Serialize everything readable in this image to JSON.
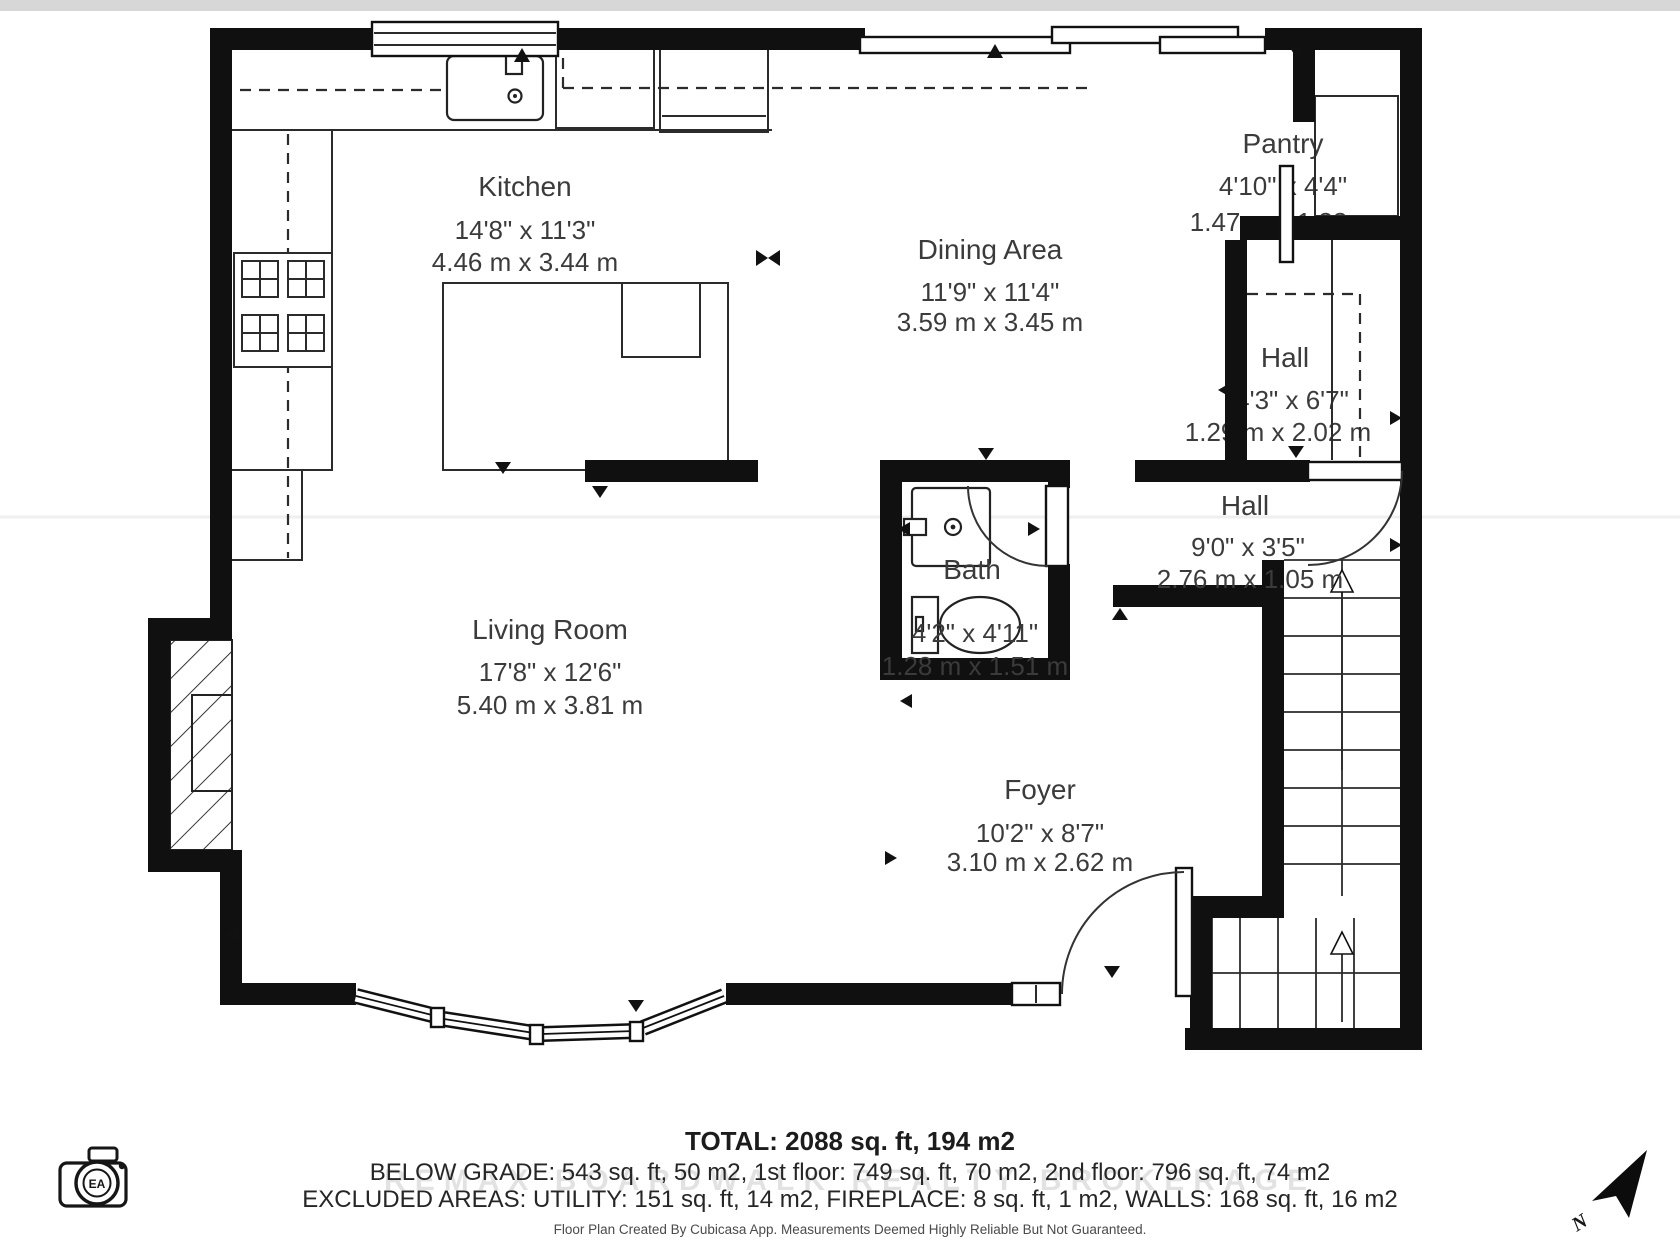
{
  "rooms": {
    "kitchen": {
      "name": "Kitchen",
      "imperial": "14'8\" x 11'3\"",
      "metric": "4.46 m x 3.44 m"
    },
    "dining": {
      "name": "Dining Area",
      "imperial": "11'9\" x 11'4\"",
      "metric": "3.59 m x 3.45 m"
    },
    "pantry": {
      "name": "Pantry",
      "imperial": "4'10\" x 4'4\"",
      "metric": "1.47 m x 1.33 m"
    },
    "hall_upper": {
      "name": "Hall",
      "imperial": "4'3\" x 6'7\"",
      "metric": "1.29 m x 2.02 m"
    },
    "hall_lower": {
      "name": "Hall",
      "imperial": "9'0\" x 3'5\"",
      "metric": "2.76 m x 1.05 m"
    },
    "bath": {
      "name": "Bath",
      "imperial": "4'2\" x 4'11\"",
      "metric": "1.28 m x 1.51 m"
    },
    "living_room": {
      "name": "Living Room",
      "imperial": "17'8\" x 12'6\"",
      "metric": "5.40 m x 3.81 m"
    },
    "foyer": {
      "name": "Foyer",
      "imperial": "10'2\" x 8'7\"",
      "metric": "3.10 m x 2.62 m"
    }
  },
  "summary": {
    "total": "TOTAL: 2088 sq. ft, 194 m2",
    "breakdown": "BELOW GRADE: 543 sq. ft, 50 m2, 1st floor: 749 sq. ft, 70 m2, 2nd floor: 796 sq. ft, 74 m2",
    "excluded": "EXCLUDED AREAS: UTILITY: 151 sq. ft, 14 m2, FIREPLACE: 8 sq. ft, 1 m2, WALLS: 168 sq. ft, 16 m2",
    "disclaimer": "Floor Plan Created By Cubicasa App. Measurements Deemed Highly Reliable But Not Guaranteed."
  },
  "watermark": {
    "text": "REMAX BOARDWALK REALTY BROKERAGE"
  },
  "compass": {
    "label": "N"
  },
  "logo": {
    "initials": "EA"
  },
  "colors": {
    "wall": "#101010",
    "text": "#3b3b3b",
    "top_strip": "#d7d7d7"
  }
}
